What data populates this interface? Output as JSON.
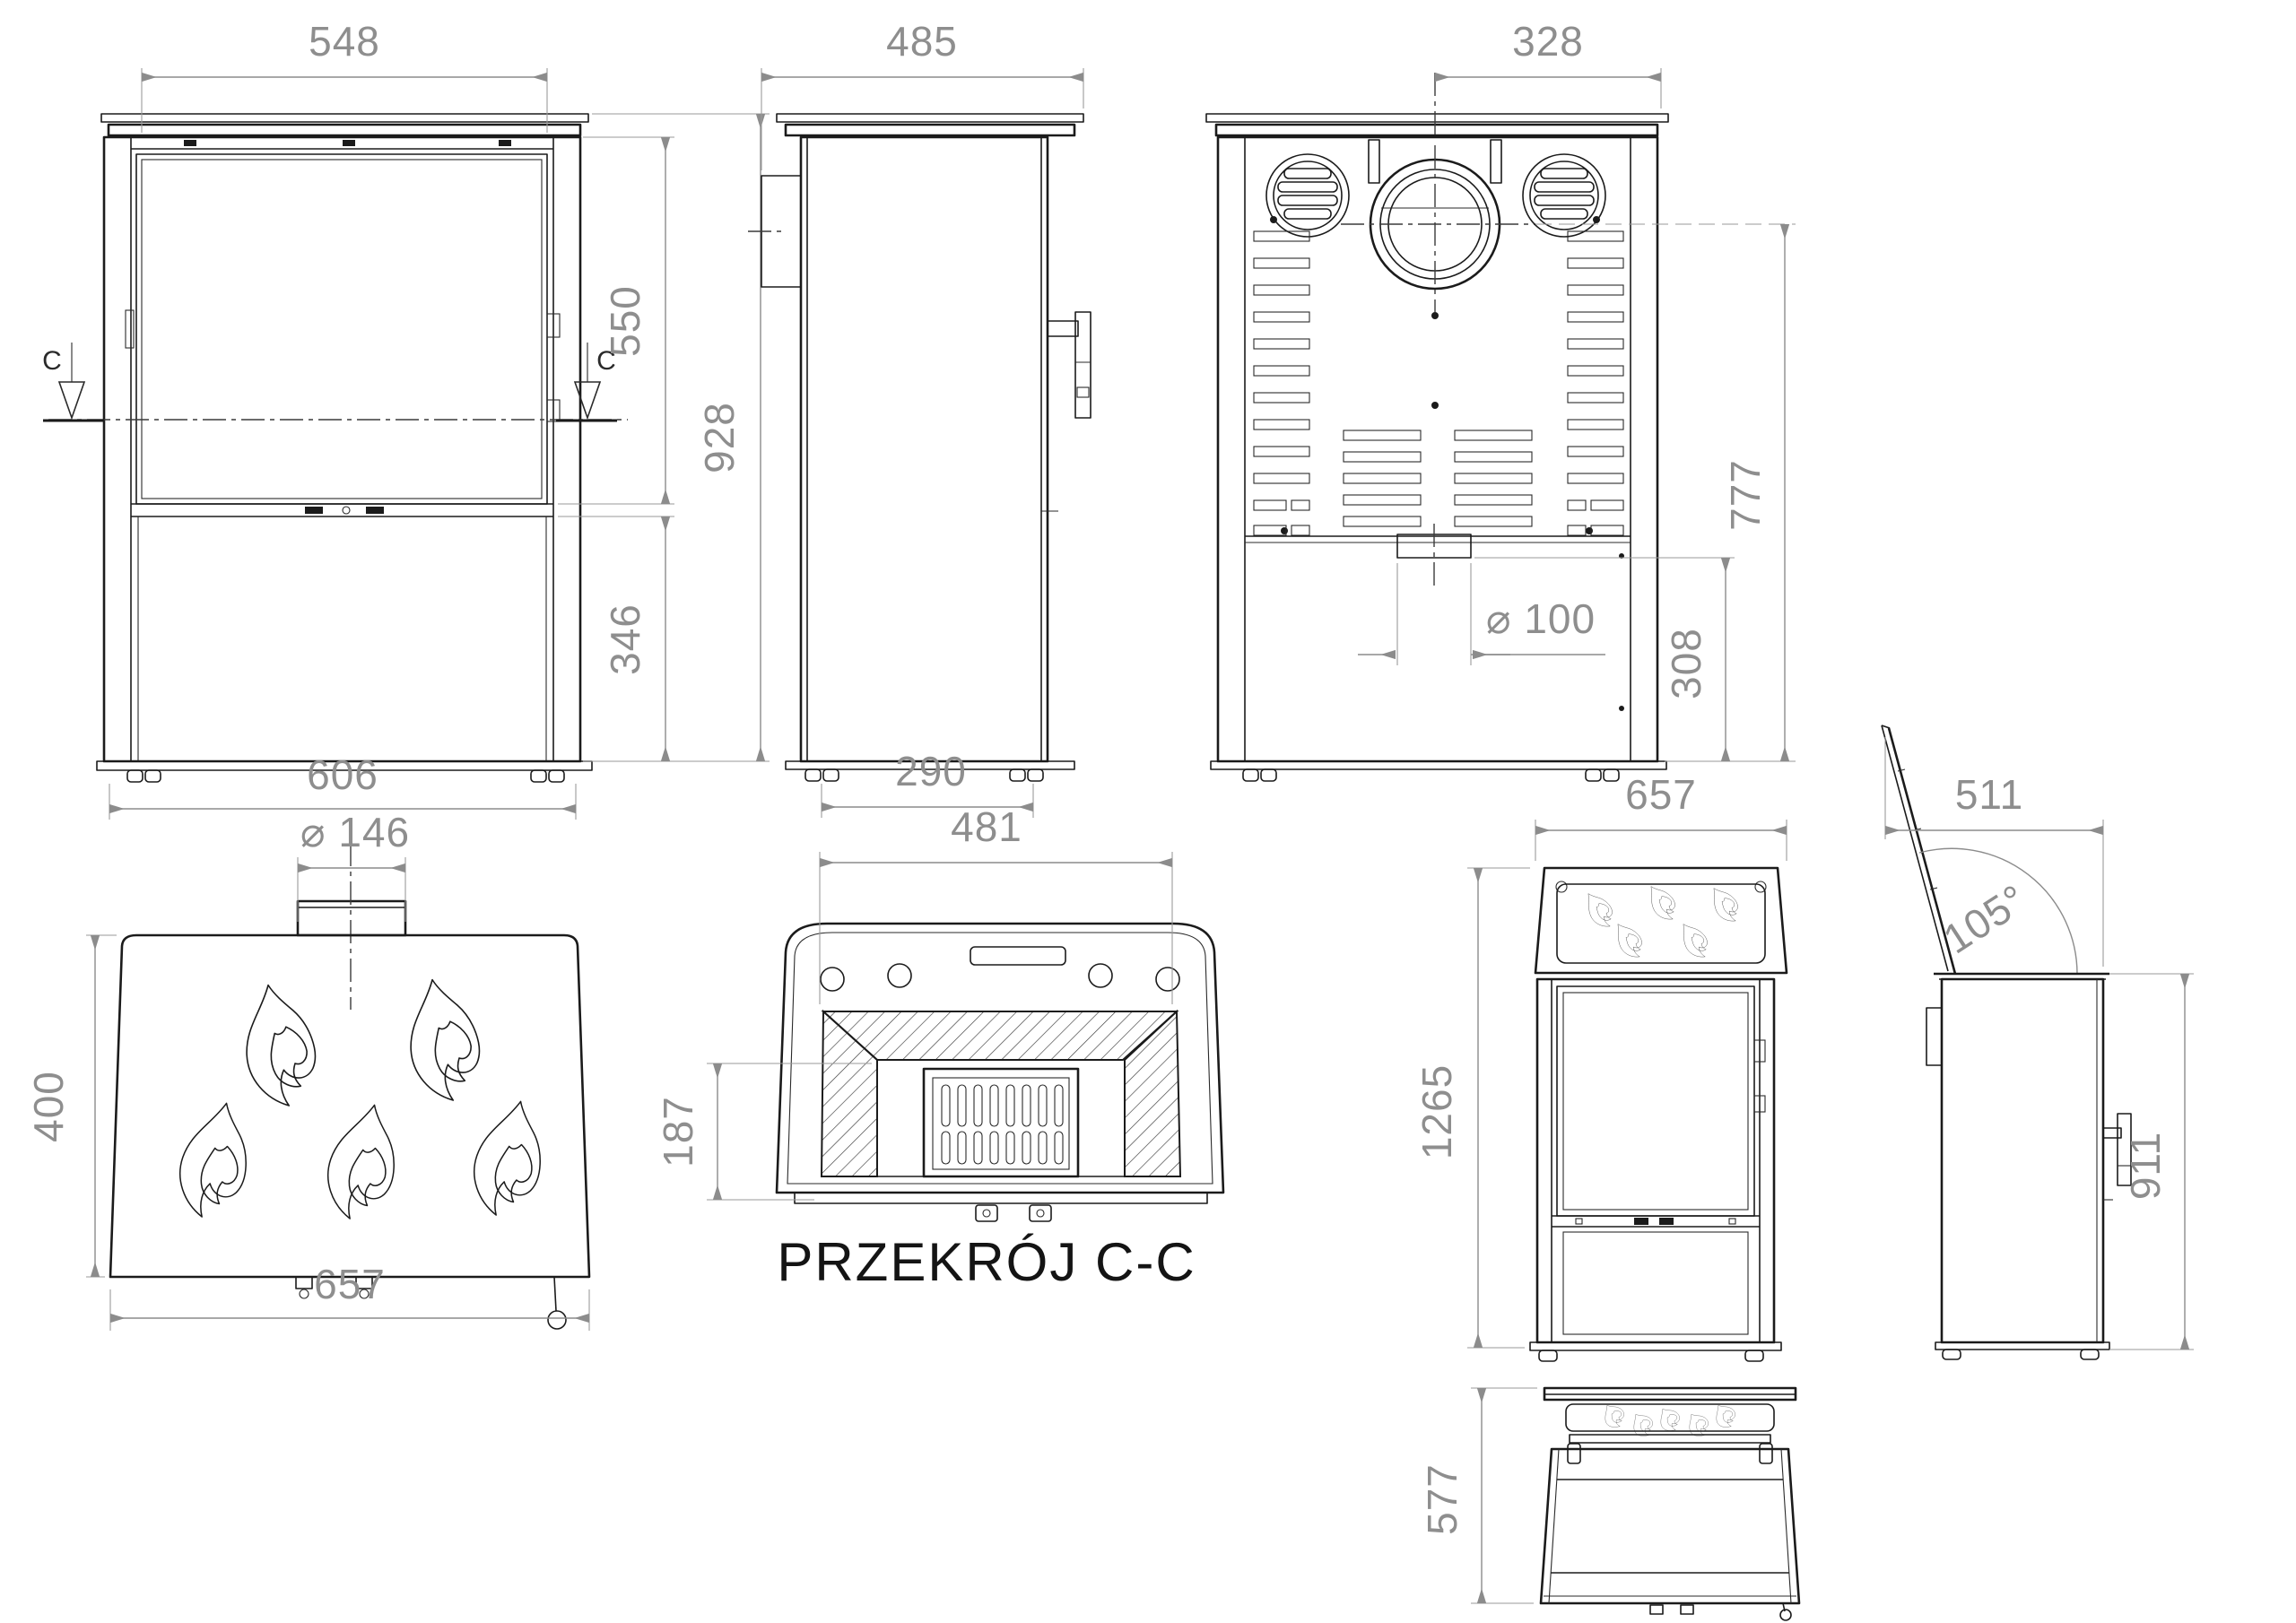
{
  "drawing": {
    "type": "stove-technical-drawing",
    "line_color": "#1b1b1b",
    "dimension_color": "#8e8e8e",
    "background": "#ffffff"
  },
  "labels": {
    "section_title": "PRZEKRÓJ C-C",
    "section_cut_marker": "C"
  },
  "dims": {
    "front_width_top": "548",
    "front_glass_height": "550",
    "front_total_height": "928",
    "front_base_height": "346",
    "front_width_bottom": "606",
    "side_depth": "485",
    "side_feet_spacing": "290",
    "rear_flue_offset": "328",
    "rear_flue_height": "777",
    "rear_outlet_diameter": "⌀ 100",
    "rear_ashpan_height": "308",
    "top_flue_diameter": "⌀ 146",
    "top_depth": "400",
    "top_width": "657",
    "section_opening_width": "481",
    "section_grate_depth": "187",
    "open_front_width": "657",
    "open_front_total_height": "1265",
    "open_side_depth": "511",
    "open_side_lid_angle": "105°",
    "open_side_body_height": "911",
    "open_top_depth": "577"
  }
}
